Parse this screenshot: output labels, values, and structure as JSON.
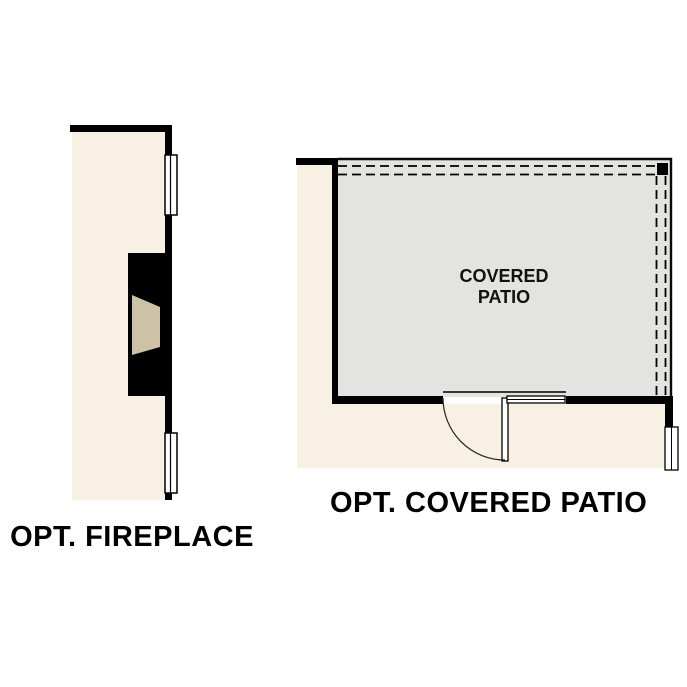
{
  "page": {
    "background_color": "#ffffff",
    "type": "floor-plan-options-diagram"
  },
  "fireplace_plan": {
    "label": "OPT. FIREPLACE",
    "colors": {
      "interior_floor": "#f8f0e3",
      "wall": "#000000",
      "firebox": "#cdc2a8",
      "window_fill": "#ffffff"
    }
  },
  "patio_plan": {
    "label": "OPT. COVERED PATIO",
    "room_label_line1": "COVERED",
    "room_label_line2": "PATIO",
    "colors": {
      "interior_floor": "#f8f0e3",
      "patio_floor": "#e3e3e1",
      "wall": "#000000",
      "overhang_dash": "#000000",
      "window_fill": "#ffffff"
    }
  }
}
